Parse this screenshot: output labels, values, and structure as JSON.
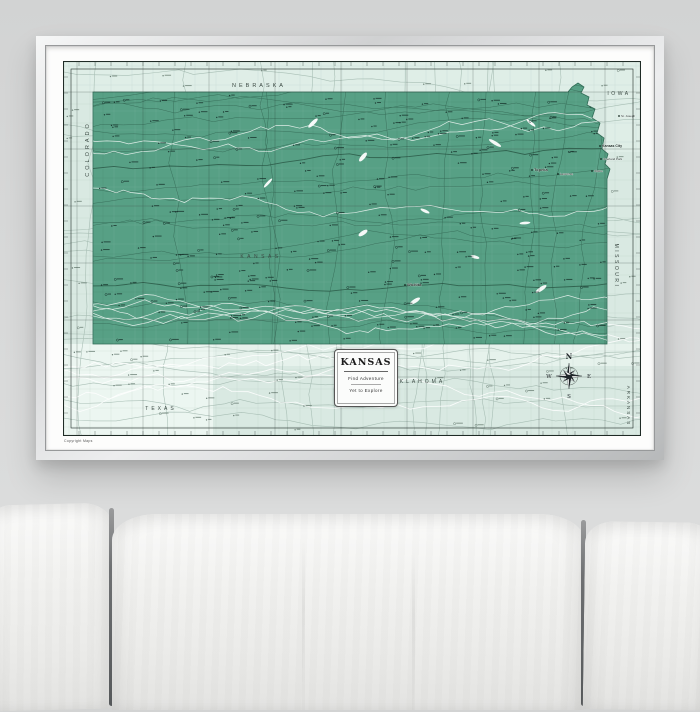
{
  "poster": {
    "title_box": {
      "title": "KANSAS",
      "tagline1": "Find Adventure",
      "tagline2": "Yet to Explore"
    },
    "compass": {
      "north": "N",
      "east": "E",
      "south": "S",
      "west": "W"
    },
    "copyright": "Copyright Maps"
  },
  "map_labels": {
    "states": [
      {
        "text": "NEBRASKA",
        "x": 196,
        "y": 26,
        "size": 5.5,
        "spacing": 3,
        "rotate": 0
      },
      {
        "text": "IOWA",
        "x": 556,
        "y": 34,
        "size": 5,
        "spacing": 2.5,
        "rotate": 0
      },
      {
        "text": "COLORADO",
        "x": 26,
        "y": 88,
        "size": 5.5,
        "spacing": 3,
        "rotate": -90
      },
      {
        "text": "MISSOURI",
        "x": 552,
        "y": 205,
        "size": 5,
        "spacing": 2.5,
        "rotate": 90
      },
      {
        "text": "ARKANSAS",
        "x": 564,
        "y": 345,
        "size": 4.5,
        "spacing": 2,
        "rotate": 90
      },
      {
        "text": "OKLAHOMA",
        "x": 356,
        "y": 322,
        "size": 5,
        "spacing": 3,
        "rotate": 0
      },
      {
        "text": "TEXAS",
        "x": 98,
        "y": 349,
        "size": 5,
        "spacing": 3,
        "rotate": 0
      },
      {
        "text": "KANSAS",
        "x": 198,
        "y": 197,
        "size": 5,
        "spacing": 3.5,
        "rotate": 0
      }
    ],
    "cities": [
      {
        "text": "Topeka",
        "x": 471,
        "y": 110,
        "size": 4,
        "bold": true
      },
      {
        "text": "Lawrence",
        "x": 497,
        "y": 114,
        "size": 3,
        "bold": false
      },
      {
        "text": "St. Joseph",
        "x": 558,
        "y": 56,
        "size": 3,
        "bold": false
      },
      {
        "text": "Kansas City",
        "x": 539,
        "y": 86,
        "size": 3.5,
        "bold": true
      },
      {
        "text": "Overland Park",
        "x": 540,
        "y": 99,
        "size": 3,
        "bold": false
      },
      {
        "text": "Olathe",
        "x": 531,
        "y": 111,
        "size": 3,
        "bold": false
      },
      {
        "text": "Wichita",
        "x": 344,
        "y": 225,
        "size": 4,
        "bold": true
      }
    ]
  },
  "colors": {
    "wall": "#d6d7d7",
    "map_bg": "#d9e9e2",
    "map_bg_north": "#dfeee7",
    "map_bg_band": "#e6f2ec",
    "map_bg_corner": "#ecf6f1",
    "state_fill": "#57a085",
    "state_fill_light": "#61a98e",
    "state_edge": "#2f6b55",
    "ink_dark": "#16302a",
    "ink_light": "#6e8278",
    "road_dark": "#24503f",
    "road_light": "#a3bab0",
    "river": "#ffffff",
    "label_ink": "#3c4a44",
    "border_ink": "#1f2b26"
  }
}
